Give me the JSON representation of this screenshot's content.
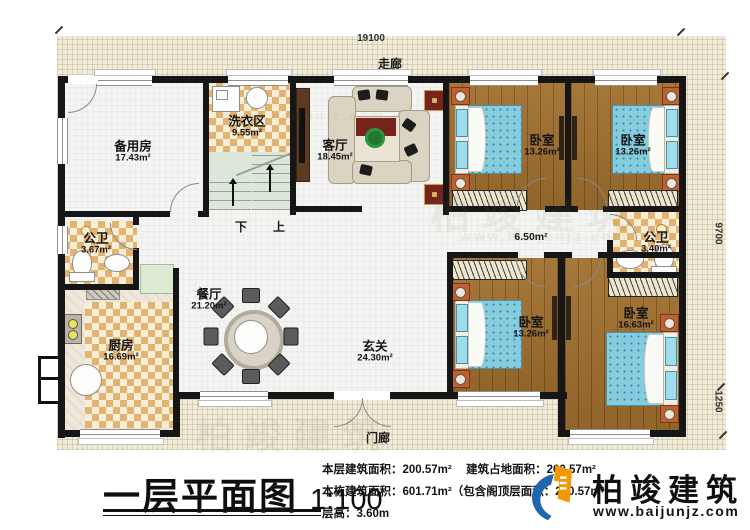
{
  "dimensions": {
    "width": "19100",
    "height_main": "9700",
    "height_porch": "1250"
  },
  "annotations": {
    "corridor": "走廊",
    "porch": "门廊",
    "hall_area": "6.50m²",
    "down": "下",
    "up": "上"
  },
  "rooms": [
    {
      "name": "备用房",
      "area": "17.43m²"
    },
    {
      "name": "洗衣区",
      "area": "9.55m²"
    },
    {
      "name": "客厅",
      "area": "18.45m²"
    },
    {
      "name": "卧室",
      "area": "13.26m²"
    },
    {
      "name": "卧室",
      "area": "13.26m²"
    },
    {
      "name": "公卫",
      "area": "3.67m²"
    },
    {
      "name": "公卫",
      "area": "3.40m²"
    },
    {
      "name": "餐厅",
      "area": "21.20m²"
    },
    {
      "name": "厨房",
      "area": "16.69m²"
    },
    {
      "name": "玄关",
      "area": "24.30m²"
    },
    {
      "name": "卧室",
      "area": "13.26m²"
    },
    {
      "name": "卧室",
      "area": "16.63m²"
    }
  ],
  "title_block": {
    "title": "一层平面图",
    "scale": "1:100",
    "stats": [
      {
        "label": "本层建筑面积：",
        "value": "200.57m²"
      },
      {
        "label": "建筑占地面积：",
        "value": "200.57m²"
      },
      {
        "label": "本栋建筑面积：",
        "value": "601.71m²（包含阁顶层面积：200.57m²"
      },
      {
        "label": "层高：",
        "value": "3.60m"
      }
    ]
  },
  "brand": {
    "name": "柏竣建筑",
    "site": "www.baijunjz.com"
  },
  "watermarks": [
    "柏竣建筑",
    "www.baijunjz.com",
    "柏竣建筑",
    "www.baijunjz.com"
  ],
  "colors": {
    "wall": "#161616",
    "wood_floor": "#a1702f",
    "checker_tan": "#e2b371",
    "bed_blue": "#85ccdf",
    "brand_blue": "#1f66ad",
    "brand_orange": "#f39800",
    "lot_bg": "#f1ecda"
  }
}
